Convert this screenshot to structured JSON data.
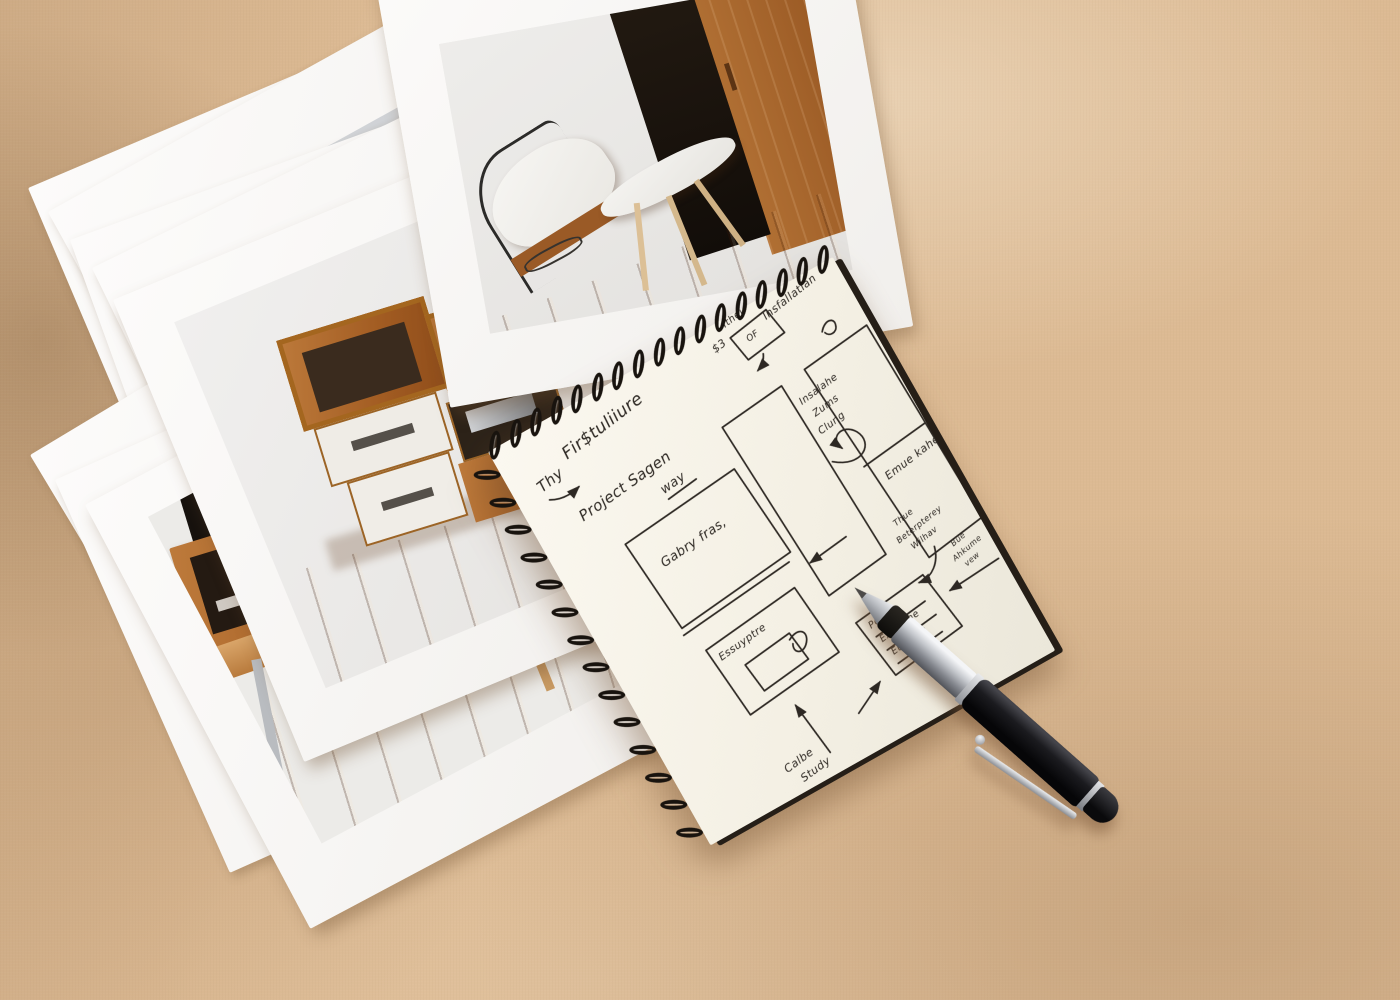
{
  "scene": {
    "description": "Flat-lay photo: fanned furniture photo prints, spiral sketchbook with hand-drawn project flowchart, and a black ballpoint pen on beige fabric"
  },
  "colors": {
    "fabric": "#dcba93",
    "photo_paper": "#fbfafa",
    "wall": "#ecebe8",
    "wood_light": "#bd7a3b",
    "wood_floor": "#a85a1e",
    "notebook_paper": "#f6f2e8",
    "ink": "#2d2823",
    "pen_black": "#121214",
    "pen_chrome": "#c2c5ca"
  },
  "photos": {
    "top_print": "room with white lounge chair, white coffee table, wooden wardrobe and dark doorway",
    "shelf_print": "modular wooden shelf unit with white drawers in white room",
    "sideboard_print": "wall-mounted wooden sideboard above long wooden table with white stool",
    "blank_sheets": "additional fanned photo prints beneath"
  },
  "notebook": {
    "sketch": {
      "thy": "Thy",
      "title": "Fir$tuliiure",
      "cost_mark": "$3",
      "ithel": "Ithel",
      "of_box": "OF",
      "installation": "Insfallatian",
      "project_line1": "Project Sagen",
      "project_line2": "way",
      "gallery_box": "Gabry fras,",
      "encryption_box": "Essuyptre",
      "insalahe": [
        "Insalahe",
        "Zums",
        "Clung"
      ],
      "ensure_box": "Emue kahe",
      "poles_box": [
        "Poles",
        "Exwulthe",
        "Eubfave"
      ],
      "note_top": [
        "Thue",
        "Beterpterey",
        "Wilhav"
      ],
      "note_right": [
        "Bue",
        "Ahkume",
        "vew"
      ],
      "study_note": [
        "Calbe",
        "Study"
      ]
    }
  },
  "pen": {
    "type": "black ballpoint pen with chrome grip and clip"
  }
}
